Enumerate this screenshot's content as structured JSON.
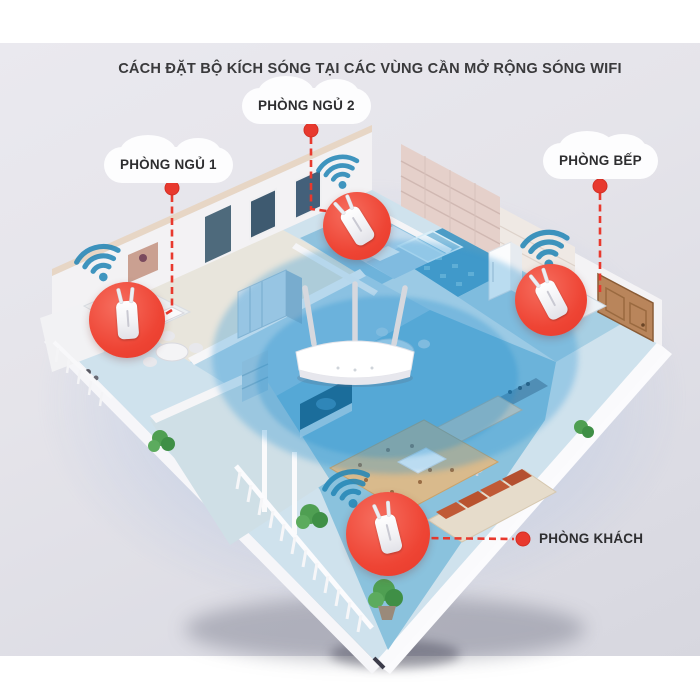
{
  "title": "CÁCH ĐẶT BỘ KÍCH SÓNG TẠI CÁC VÙNG CẦN MỞ RỘNG SÓNG WIFI",
  "rooms": {
    "bedroom1": {
      "label": "PHÒNG NGỦ 1"
    },
    "bedroom2": {
      "label": "PHÒNG NGỦ 2"
    },
    "kitchen": {
      "label": "PHÒNG BẾP"
    },
    "living": {
      "label": "PHÒNG KHÁCH"
    }
  },
  "devices": {
    "router": "wifi-router-with-3-antennas",
    "extender": "wifi-range-extender",
    "extender_locations": [
      "bedroom1",
      "bedroom2",
      "kitchen",
      "living"
    ]
  },
  "icons": {
    "wifi_signal": "wifi-signal-icon",
    "marker_dot": "red-marker-dot",
    "label_bubble": "cloud-bubble"
  },
  "colors": {
    "accent_red": "#e8392e",
    "wifi_teal": "#2587b7",
    "coverage_blue": "#2694d4",
    "background_gray": "#e4e3ea"
  }
}
